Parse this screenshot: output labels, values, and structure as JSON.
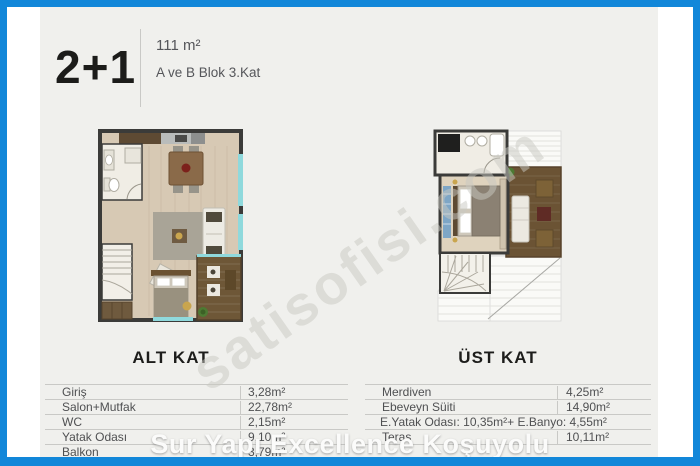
{
  "colors": {
    "frame_blue": "#1287d9",
    "panel_bg": "#f0f0ed",
    "accent_gold": "#c9a54e"
  },
  "header": {
    "type_label": "2+1",
    "area": "111 m²",
    "block_info": "A ve B Blok 3.Kat"
  },
  "plans": [
    {
      "caption": "ALT KAT"
    },
    {
      "caption": "ÜST KAT"
    }
  ],
  "tables": {
    "alt": {
      "rows": [
        {
          "label": "Giriş",
          "value": "3,28m²"
        },
        {
          "label": "Salon+Mutfak",
          "value": "22,78m²"
        },
        {
          "label": "WC",
          "value": "2,15m²"
        },
        {
          "label": "Yatak Odası",
          "value": "9,10m²"
        },
        {
          "label": "Balkon",
          "value": "3,79m²"
        }
      ]
    },
    "ust": {
      "rows": [
        {
          "label": "Merdiven",
          "value": "4,25m²"
        },
        {
          "label": "Ebeveyn Süiti",
          "value": "14,90m²"
        },
        {
          "label": "E.Yatak Odası: 10,35m²+ E.Banyo: 4,55m²",
          "value": ""
        },
        {
          "label": "Teras",
          "value": "10,11m²"
        }
      ]
    }
  },
  "watermarks": {
    "diagonal": "satisofisi.com",
    "banner": "Sur Yapı Excellence Koşuyolu"
  }
}
